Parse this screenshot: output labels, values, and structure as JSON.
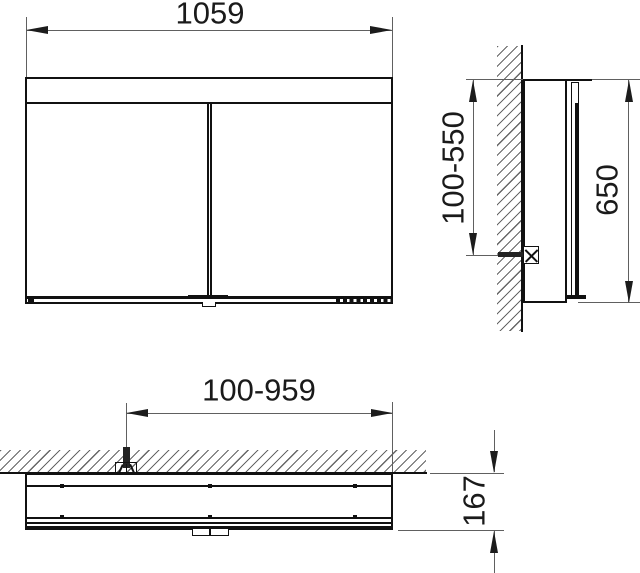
{
  "drawing": {
    "type": "technical-installation-drawing",
    "views": {
      "front": {
        "label": "front-view",
        "width_label": "1059"
      },
      "side": {
        "label": "side-view",
        "mount_height_label": "100-550",
        "height_label": "650"
      },
      "plan": {
        "label": "plan-view",
        "mount_width_label": "100-959",
        "depth_label": "167"
      }
    },
    "colors": {
      "background": "#ffffff",
      "object_line": "#111111",
      "dimension_line": "#606060",
      "text": "#1a1a1a"
    }
  }
}
